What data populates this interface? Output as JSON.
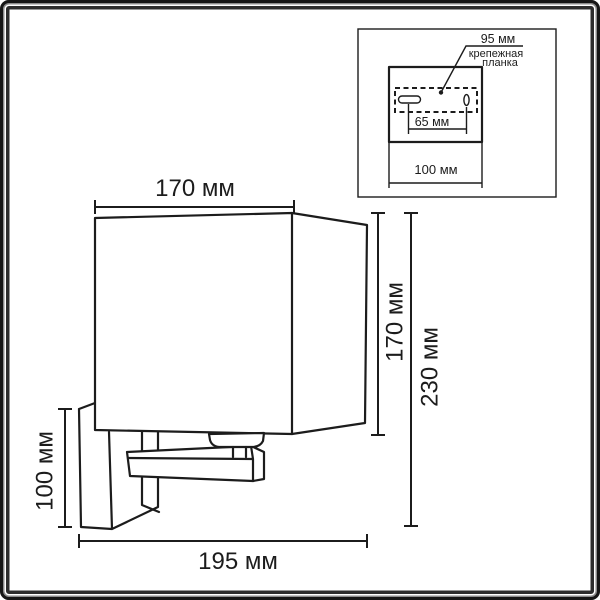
{
  "main_view": {
    "shade_width_label": "170 мм",
    "shade_height_label": "170 мм",
    "overall_height_label": "230 мм",
    "backplate_height_label": "100 мм",
    "overall_depth_label": "195 мм"
  },
  "inset": {
    "mounting_pitch_label": "95 мм",
    "bracket_caption_line1": "крепежная",
    "bracket_caption_line2": "планка",
    "hole_spacing_label": "65 мм",
    "plate_width_label": "100 мм"
  },
  "colors": {
    "line": "#1c1c1c",
    "background": "#ffffff",
    "frame_outer": "#161616",
    "frame_mid_gray": "#8b8b8b",
    "frame_inner_dark": "#2d2d2d"
  }
}
